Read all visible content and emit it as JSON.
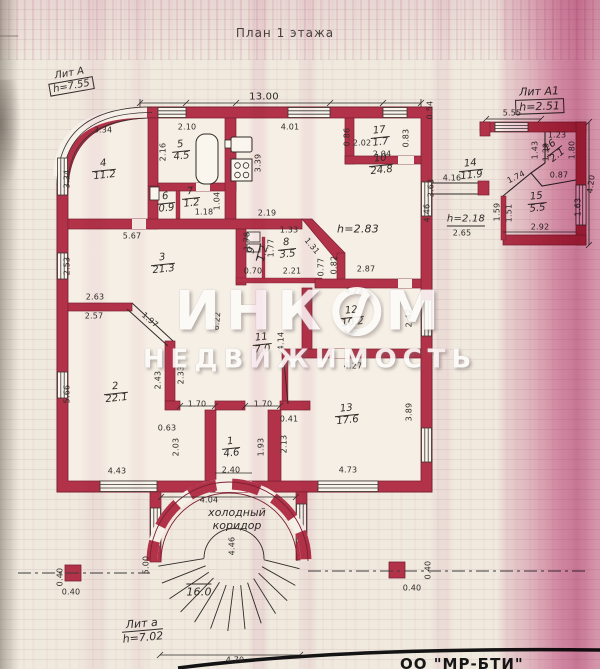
{
  "title": "План 1 этажа",
  "legend": {
    "lit_a_label": "Лит А",
    "lit_a_height": "h=7.55",
    "lit_a1_label": "Лит А1",
    "lit_a1_height": "h=2.51",
    "lit_a_small_label": "Лит а",
    "lit_a_small_height": "h=7.02"
  },
  "corridor": {
    "line1": "холодный",
    "line2": "коридор"
  },
  "watermark": {
    "word1_left": "ИНК",
    "word1_right": "М",
    "word2": "НЕДВИЖИМОСТЬ"
  },
  "bottom_text": "ОО \"МР-БТИ\"",
  "colors": {
    "wall": "#b23349",
    "wall_edge": "#7d1f33",
    "paper": "#efe9de",
    "ink": "#2f2b28",
    "streak_pink": "#c24a86",
    "watermark": "#fdfcfa"
  },
  "rooms": [
    {
      "num": "1",
      "area": "4.6",
      "x": 231,
      "y": 448,
      "rot": -6
    },
    {
      "num": "2",
      "area": "22.1",
      "x": 116,
      "y": 393,
      "rot": -6
    },
    {
      "num": "3",
      "area": "21.3",
      "x": 163,
      "y": 264,
      "rot": -6
    },
    {
      "num": "4",
      "area": "11.2",
      "x": 104,
      "y": 170,
      "rot": -6
    },
    {
      "num": "5",
      "area": "4.5",
      "x": 181,
      "y": 151,
      "rot": -6
    },
    {
      "num": "6",
      "area": "0.9",
      "x": 166,
      "y": 203,
      "rot": -6
    },
    {
      "num": "7",
      "area": "1.2",
      "x": 191,
      "y": 198,
      "rot": -6
    },
    {
      "num": "8",
      "area": "3.5",
      "x": 287,
      "y": 249,
      "rot": -6
    },
    {
      "num": "9",
      "area": "1.2",
      "x": 258,
      "y": 252,
      "rot": -75
    },
    {
      "num": "10",
      "area": "24.8",
      "x": 381,
      "y": 165,
      "rot": -6
    },
    {
      "num": "11",
      "area": "7.0",
      "x": 262,
      "y": 344,
      "rot": -6
    },
    {
      "num": "12",
      "area": "10.2",
      "x": 352,
      "y": 317,
      "rot": -6
    },
    {
      "num": "13",
      "area": "17.6",
      "x": 347,
      "y": 415,
      "rot": -6
    },
    {
      "num": "14",
      "area": "11.9",
      "x": 471,
      "y": 170,
      "rot": -6
    },
    {
      "num": "15",
      "area": "5.5",
      "x": 537,
      "y": 203,
      "rot": -6
    },
    {
      "num": "16",
      "area": "2.1",
      "x": 554,
      "y": 151,
      "rot": -38
    },
    {
      "num": "17",
      "area": "1.7",
      "x": 380,
      "y": 137,
      "rot": -6
    }
  ],
  "dims": [
    {
      "t": "13.00",
      "x": 264,
      "y": 97,
      "s": 10
    },
    {
      "t": "3.34",
      "x": 103,
      "y": 130
    },
    {
      "t": "2.10",
      "x": 187,
      "y": 127
    },
    {
      "t": "4.01",
      "x": 290,
      "y": 127
    },
    {
      "t": "0.86",
      "x": 347,
      "y": 137,
      "r": -90
    },
    {
      "t": "2.02",
      "x": 362,
      "y": 143
    },
    {
      "t": "0.83",
      "x": 406,
      "y": 138,
      "r": -90
    },
    {
      "t": "2.04",
      "x": 382,
      "y": 154
    },
    {
      "t": "0.54",
      "x": 430,
      "y": 110,
      "r": -90
    },
    {
      "t": "5.55",
      "x": 512,
      "y": 113
    },
    {
      "t": "2.16",
      "x": 163,
      "y": 152,
      "r": -90
    },
    {
      "t": "3.39",
      "x": 258,
      "y": 163,
      "r": -90
    },
    {
      "t": "3.34",
      "x": 67,
      "y": 179,
      "r": -90
    },
    {
      "t": "5.67",
      "x": 132,
      "y": 236
    },
    {
      "t": "2.53",
      "x": 67,
      "y": 266,
      "r": -90
    },
    {
      "t": "2.63",
      "x": 95,
      "y": 297
    },
    {
      "t": "2.57",
      "x": 94,
      "y": 316
    },
    {
      "t": "1.97",
      "x": 150,
      "y": 320,
      "r": 40
    },
    {
      "t": "5.66",
      "x": 67,
      "y": 394,
      "r": -90
    },
    {
      "t": "4.43",
      "x": 117,
      "y": 471
    },
    {
      "t": "2.43",
      "x": 158,
      "y": 380,
      "r": -90
    },
    {
      "t": "2.33",
      "x": 181,
      "y": 375,
      "r": -90
    },
    {
      "t": "1.18",
      "x": 204,
      "y": 212
    },
    {
      "t": "1.04",
      "x": 217,
      "y": 201,
      "r": -90
    },
    {
      "t": "2.19",
      "x": 267,
      "y": 213
    },
    {
      "t": "1.33",
      "x": 289,
      "y": 230
    },
    {
      "t": "1.78",
      "x": 247,
      "y": 241,
      "r": -90
    },
    {
      "t": "1.77",
      "x": 271,
      "y": 248,
      "r": -90
    },
    {
      "t": "1.31",
      "x": 312,
      "y": 246,
      "r": 50
    },
    {
      "t": "0.70",
      "x": 253,
      "y": 271
    },
    {
      "t": "2.21",
      "x": 292,
      "y": 271
    },
    {
      "t": "0.77",
      "x": 321,
      "y": 267,
      "r": -90
    },
    {
      "t": "0.82",
      "x": 334,
      "y": 265,
      "r": -90
    },
    {
      "t": "2.87",
      "x": 366,
      "y": 269
    },
    {
      "t": "h=2.83",
      "x": 358,
      "y": 229,
      "s": 11,
      "i": 1
    },
    {
      "t": "4.22",
      "x": 354,
      "y": 291
    },
    {
      "t": "2.42",
      "x": 409,
      "y": 318,
      "r": -90
    },
    {
      "t": "4.27",
      "x": 353,
      "y": 366
    },
    {
      "t": "3.89",
      "x": 409,
      "y": 412,
      "r": -90
    },
    {
      "t": "6.22",
      "x": 217,
      "y": 321,
      "r": -85
    },
    {
      "t": "4.14",
      "x": 281,
      "y": 341,
      "r": -90
    },
    {
      "t": "1.70",
      "x": 197,
      "y": 404
    },
    {
      "t": "1.70",
      "x": 263,
      "y": 404
    },
    {
      "t": "0.41",
      "x": 289,
      "y": 419
    },
    {
      "t": "0.63",
      "x": 167,
      "y": 428
    },
    {
      "t": "2.03",
      "x": 176,
      "y": 447,
      "r": -90
    },
    {
      "t": "1.93",
      "x": 261,
      "y": 447,
      "r": -90
    },
    {
      "t": "2.13",
      "x": 284,
      "y": 444,
      "r": -90
    },
    {
      "t": "2.40",
      "x": 231,
      "y": 470
    },
    {
      "t": "4.73",
      "x": 348,
      "y": 470
    },
    {
      "t": "3.63",
      "x": 431,
      "y": 188,
      "r": -90
    },
    {
      "t": "4.46",
      "x": 427,
      "y": 213,
      "r": -90
    },
    {
      "t": "h=2.18",
      "x": 466,
      "y": 220,
      "s": 10,
      "i": 1,
      "u": 1
    },
    {
      "t": "2.65",
      "x": 462,
      "y": 233
    },
    {
      "t": "4.16",
      "x": 452,
      "y": 178
    },
    {
      "t": "1.59",
      "x": 497,
      "y": 212,
      "r": -90
    },
    {
      "t": "1.51",
      "x": 509,
      "y": 213,
      "r": -90
    },
    {
      "t": "2.92",
      "x": 540,
      "y": 227
    },
    {
      "t": "1.74",
      "x": 516,
      "y": 177,
      "r": -26
    },
    {
      "t": "0.87",
      "x": 559,
      "y": 175
    },
    {
      "t": "1.23",
      "x": 557,
      "y": 135
    },
    {
      "t": "1.43",
      "x": 535,
      "y": 150,
      "r": -90
    },
    {
      "t": "1.39",
      "x": 546,
      "y": 152,
      "r": -90
    },
    {
      "t": "1.80",
      "x": 572,
      "y": 150,
      "r": -90
    },
    {
      "t": "1.63",
      "x": 578,
      "y": 207,
      "r": -90
    },
    {
      "t": "4.20",
      "x": 591,
      "y": 184,
      "r": -83
    },
    {
      "t": "4.04",
      "x": 209,
      "y": 500
    },
    {
      "t": "4.46",
      "x": 232,
      "y": 546,
      "r": -90
    },
    {
      "t": "5.00",
      "x": 146,
      "y": 565,
      "r": -90
    },
    {
      "t": "16.0",
      "x": 199,
      "y": 591,
      "s": 11,
      "i": 1,
      "o": 1
    },
    {
      "t": "0.40",
      "x": 60,
      "y": 577,
      "r": -90
    },
    {
      "t": "0.40",
      "x": 71,
      "y": 592
    },
    {
      "t": "0.40",
      "x": 428,
      "y": 570,
      "r": -90
    },
    {
      "t": "0.40",
      "x": 412,
      "y": 588
    },
    {
      "t": "4.70",
      "x": 235,
      "y": 660
    }
  ]
}
